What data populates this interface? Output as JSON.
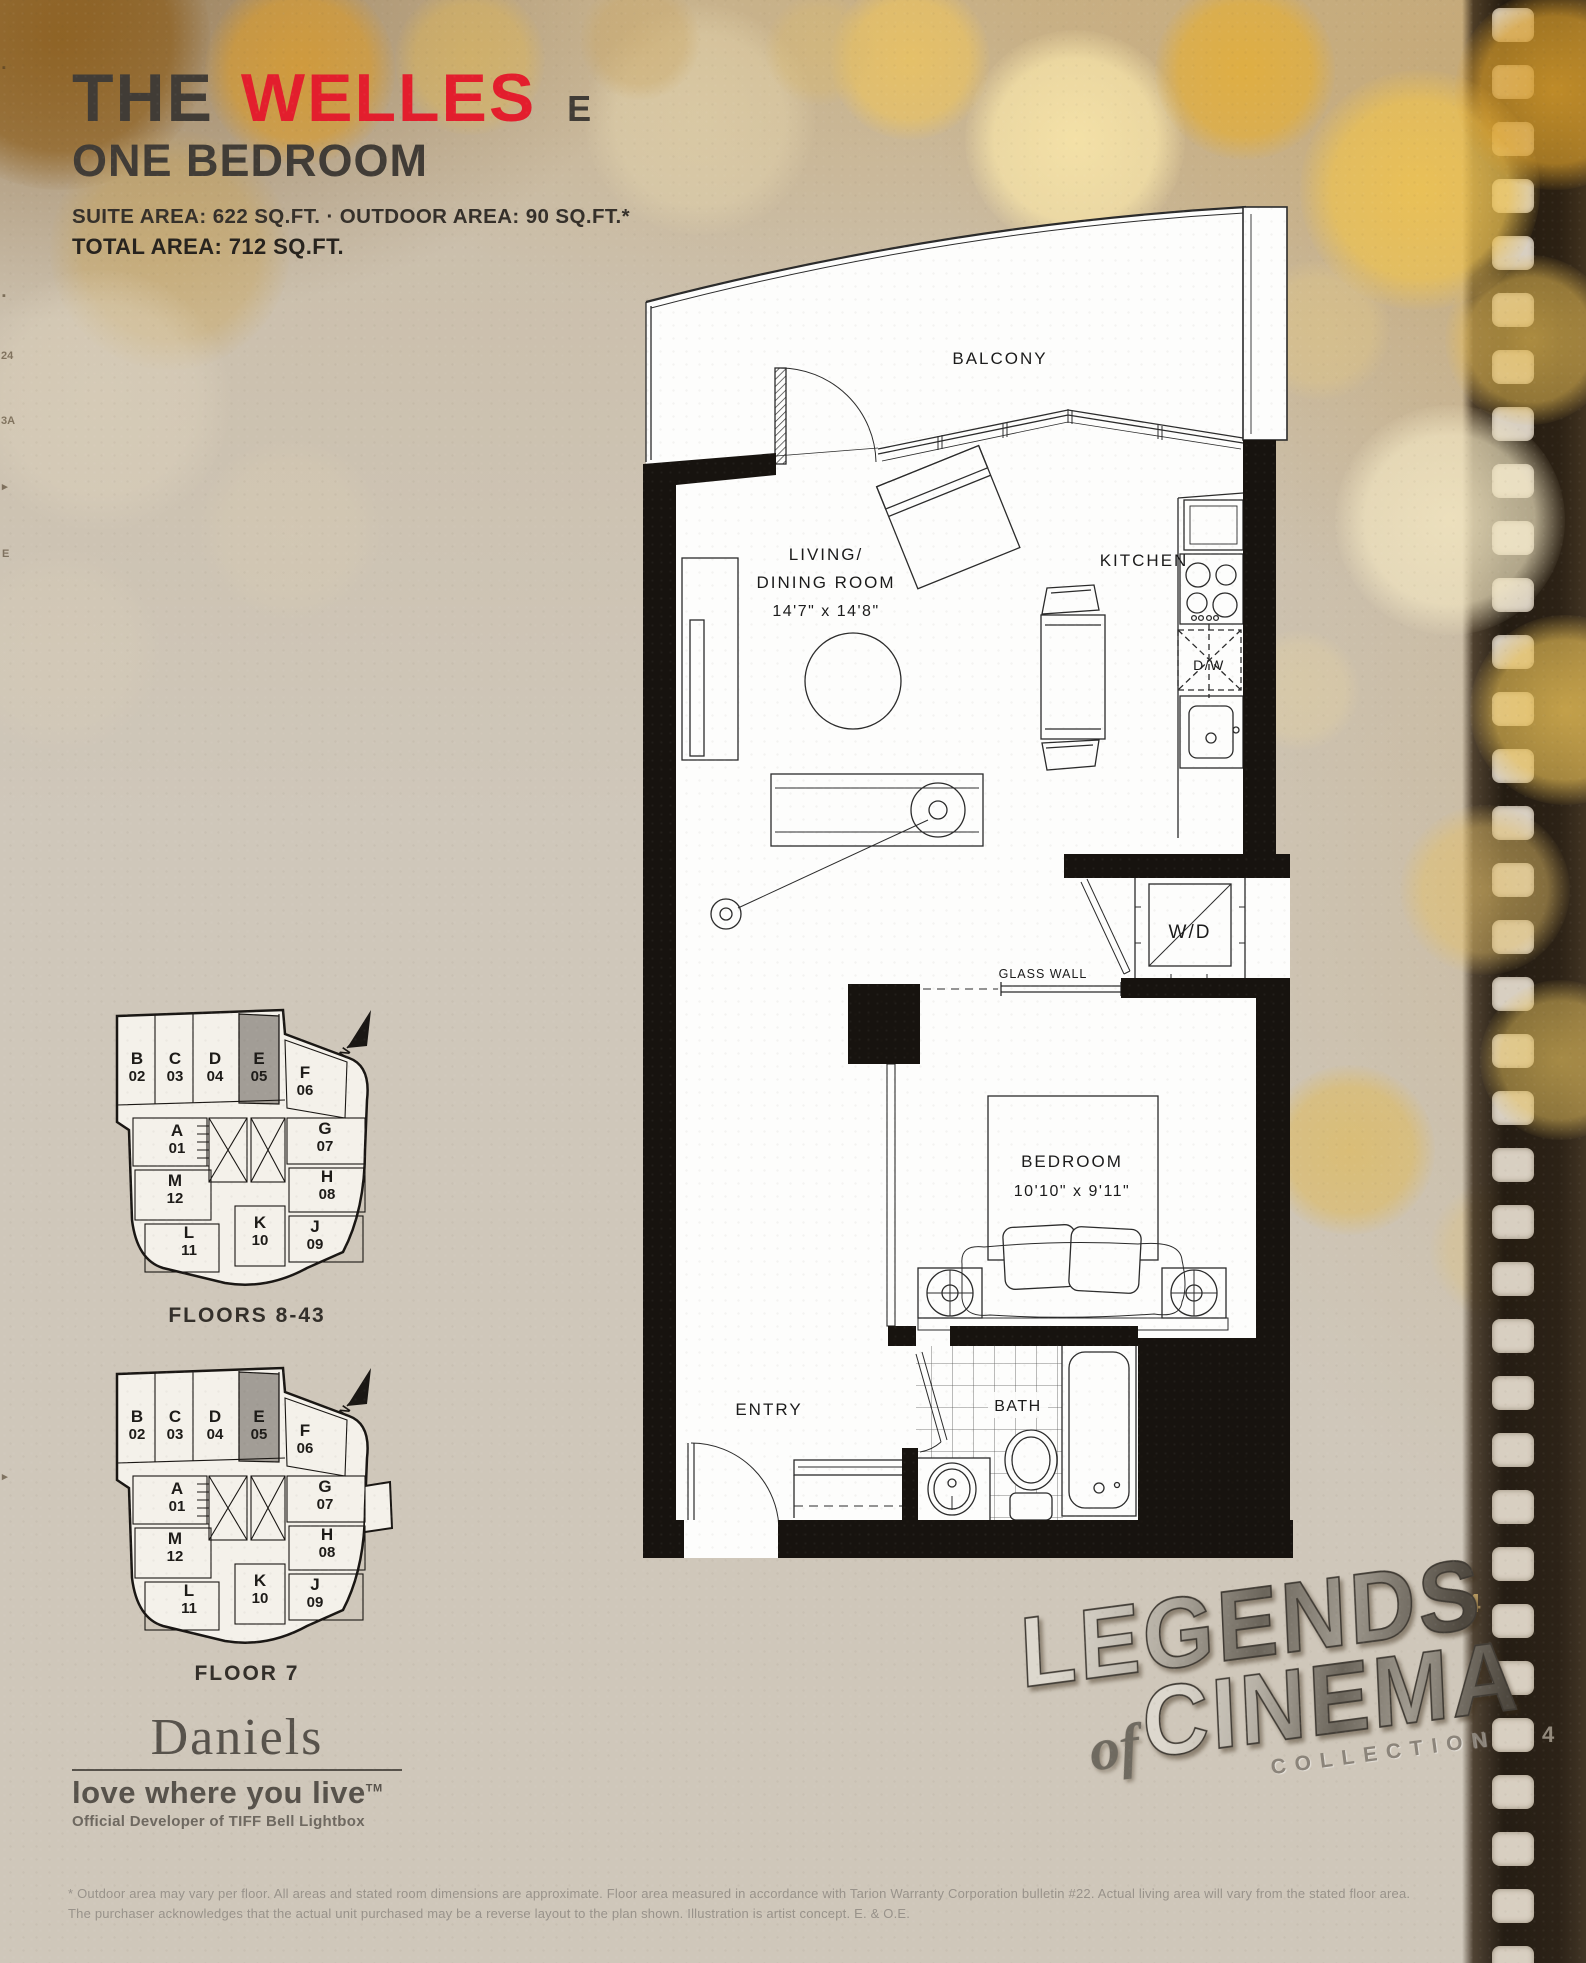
{
  "header": {
    "title_prefix": "THE",
    "title_name": "WELLES",
    "suite_letter": "E",
    "plan_type": "ONE BEDROOM",
    "suite_area_line": "SUITE AREA: 622 SQ.FT. · OUTDOOR AREA: 90 SQ.FT.*",
    "total_area_line": "TOTAL AREA: 712 SQ.FT."
  },
  "floorplan": {
    "balcony_label": "BALCONY",
    "living_label_1": "LIVING/",
    "living_label_2": "DINING ROOM",
    "living_dims": "14'7\" x 14'8\"",
    "kitchen_label": "KITCHEN",
    "dw_label": "D/W",
    "wd_label": "W/D",
    "glass_wall_label": "GLASS WALL",
    "bedroom_label": "BEDROOM",
    "bedroom_dims": "10'10\" x 9'11\"",
    "entry_label": "ENTRY",
    "bath_label": "BATH"
  },
  "keyplans": [
    {
      "caption": "FLOORS 8-43",
      "north_label": "N",
      "highlighted_unit": "E05",
      "units": [
        {
          "letter": "B",
          "number": "02"
        },
        {
          "letter": "C",
          "number": "03"
        },
        {
          "letter": "D",
          "number": "04"
        },
        {
          "letter": "E",
          "number": "05"
        },
        {
          "letter": "F",
          "number": "06"
        },
        {
          "letter": "A",
          "number": "01"
        },
        {
          "letter": "G",
          "number": "07"
        },
        {
          "letter": "M",
          "number": "12"
        },
        {
          "letter": "H",
          "number": "08"
        },
        {
          "letter": "L",
          "number": "11"
        },
        {
          "letter": "K",
          "number": "10"
        },
        {
          "letter": "J",
          "number": "09"
        }
      ]
    },
    {
      "caption": "FLOOR 7",
      "north_label": "N",
      "highlighted_unit": "E05",
      "units": [
        {
          "letter": "B",
          "number": "02"
        },
        {
          "letter": "C",
          "number": "03"
        },
        {
          "letter": "D",
          "number": "04"
        },
        {
          "letter": "E",
          "number": "05"
        },
        {
          "letter": "F",
          "number": "06"
        },
        {
          "letter": "A",
          "number": "01"
        },
        {
          "letter": "G",
          "number": "07"
        },
        {
          "letter": "M",
          "number": "12"
        },
        {
          "letter": "H",
          "number": "08"
        },
        {
          "letter": "L",
          "number": "11"
        },
        {
          "letter": "K",
          "number": "10"
        },
        {
          "letter": "J",
          "number": "09"
        }
      ]
    }
  ],
  "branding": {
    "name": "Daniels",
    "tagline": "love where you live",
    "tagline_tm": "TM",
    "developer": "Official Developer of TIFF Bell Lightbox"
  },
  "collection": {
    "word1": "LEGENDS",
    "word_of": "of",
    "word2": "CINEMA",
    "word3": "COLLECTION"
  },
  "footer": {
    "line1": "* Outdoor area may vary per floor. All areas and stated room dimensions are approximate. Floor area measured in accordance with Tarion Warranty Corporation bulletin #22. Actual living area will vary from the stated floor area.",
    "line2": "The purchaser acknowledges that the actual unit purchased may be a reverse layout to the plan shown.  Illustration is artist concept. E. & O.E."
  },
  "colors": {
    "accent_red": "#e31e2d",
    "ink": "#3f3a34",
    "unit_highlight": "#a29d96",
    "film_hole": "#d8cfc1"
  }
}
